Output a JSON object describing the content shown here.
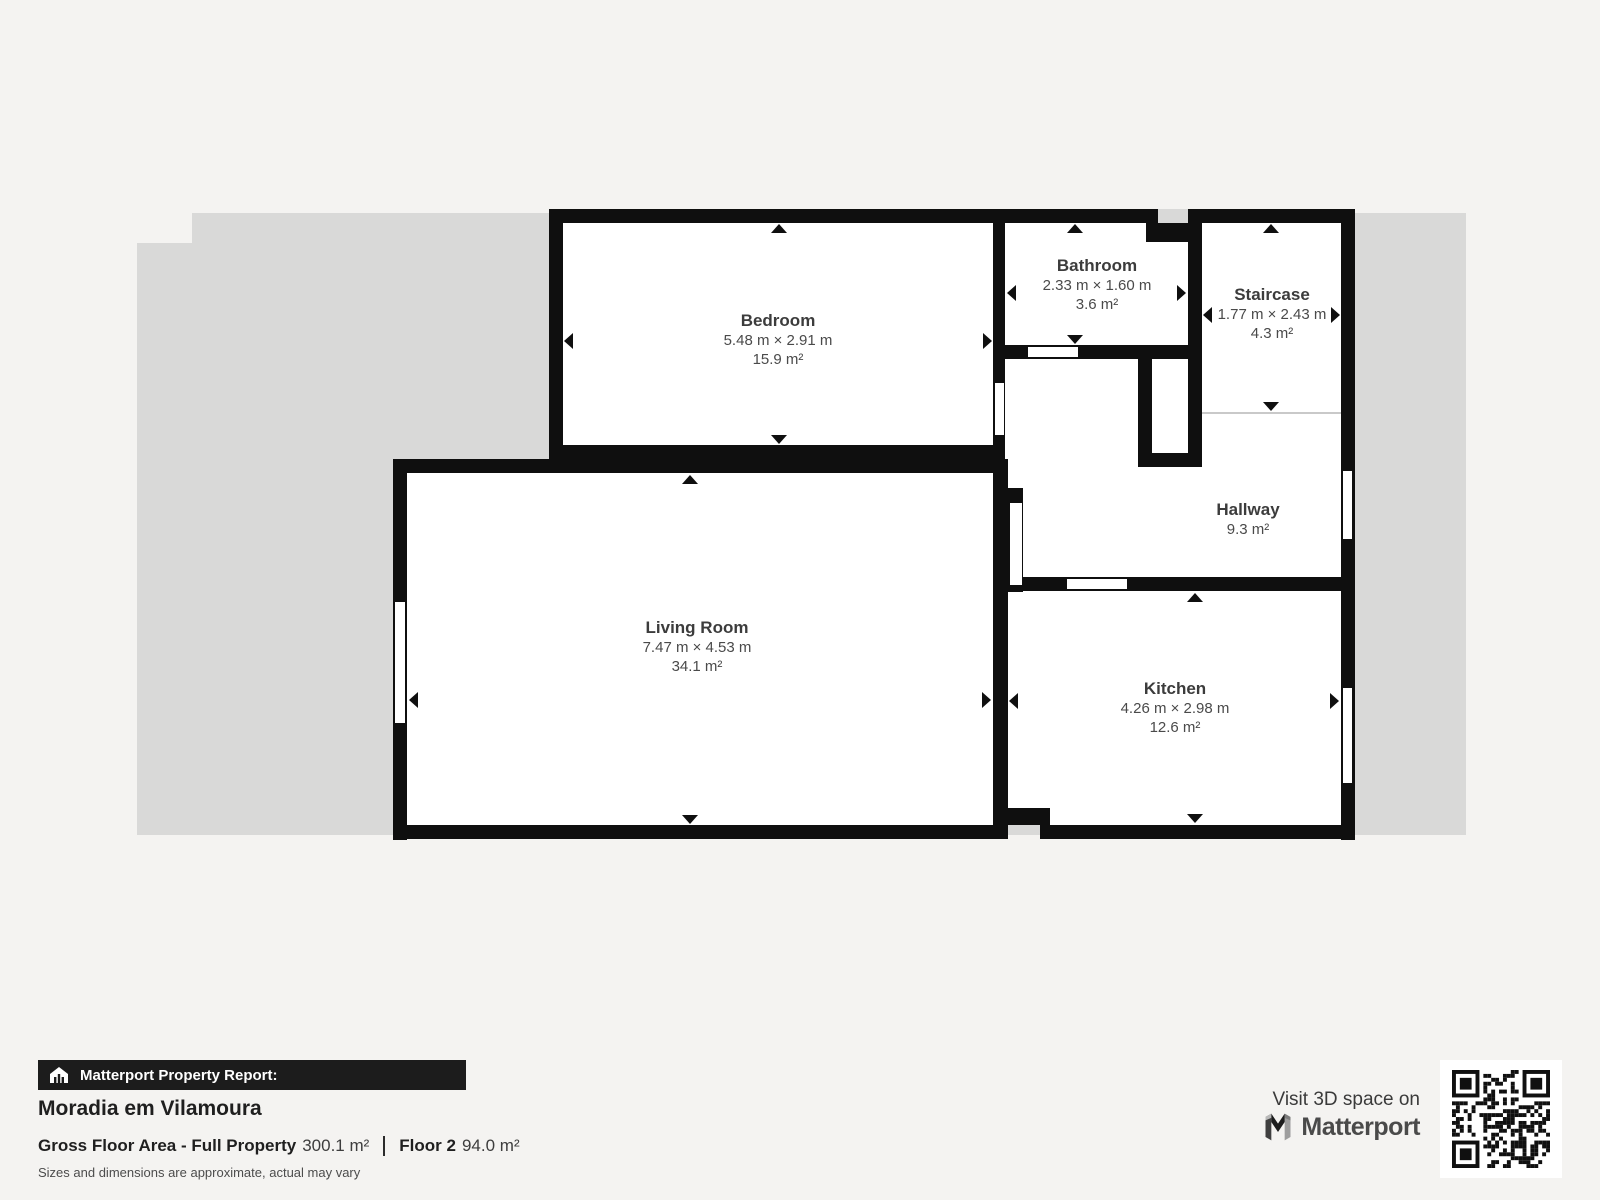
{
  "plan": {
    "rooms": [
      {
        "name": "Bedroom",
        "dimensions": "5.48 m × 2.91 m",
        "area": "15.9 m²"
      },
      {
        "name": "Bathroom",
        "dimensions": "2.33 m × 1.60 m",
        "area": "3.6 m²"
      },
      {
        "name": "Staircase",
        "dimensions": "1.77 m × 2.43 m",
        "area": "4.3 m²"
      },
      {
        "name": "Hallway",
        "dimensions": "",
        "area": "9.3 m²"
      },
      {
        "name": "Living Room",
        "dimensions": "7.47 m × 4.53 m",
        "area": "34.1 m²"
      },
      {
        "name": "Kitchen",
        "dimensions": "4.26 m × 2.98 m",
        "area": "12.6 m²"
      }
    ]
  },
  "report": {
    "banner": "Matterport Property Report:",
    "property_name": "Moradia em Vilamoura",
    "gross_label": "Gross Floor Area - Full Property",
    "gross_value": "300.1 m²",
    "floor_label": "Floor 2",
    "floor_value": "94.0 m²",
    "disclaimer": "Sizes and dimensions are approximate, actual may vary"
  },
  "footer": {
    "visit_text": "Visit 3D space on",
    "brand": "Matterport"
  },
  "colors": {
    "page_bg": "#f4f3f1",
    "backdrop": "#d9d9d8",
    "wall": "#0f0f0f",
    "banner_bg": "#1c1c1c",
    "label": "#3c3c3c"
  }
}
